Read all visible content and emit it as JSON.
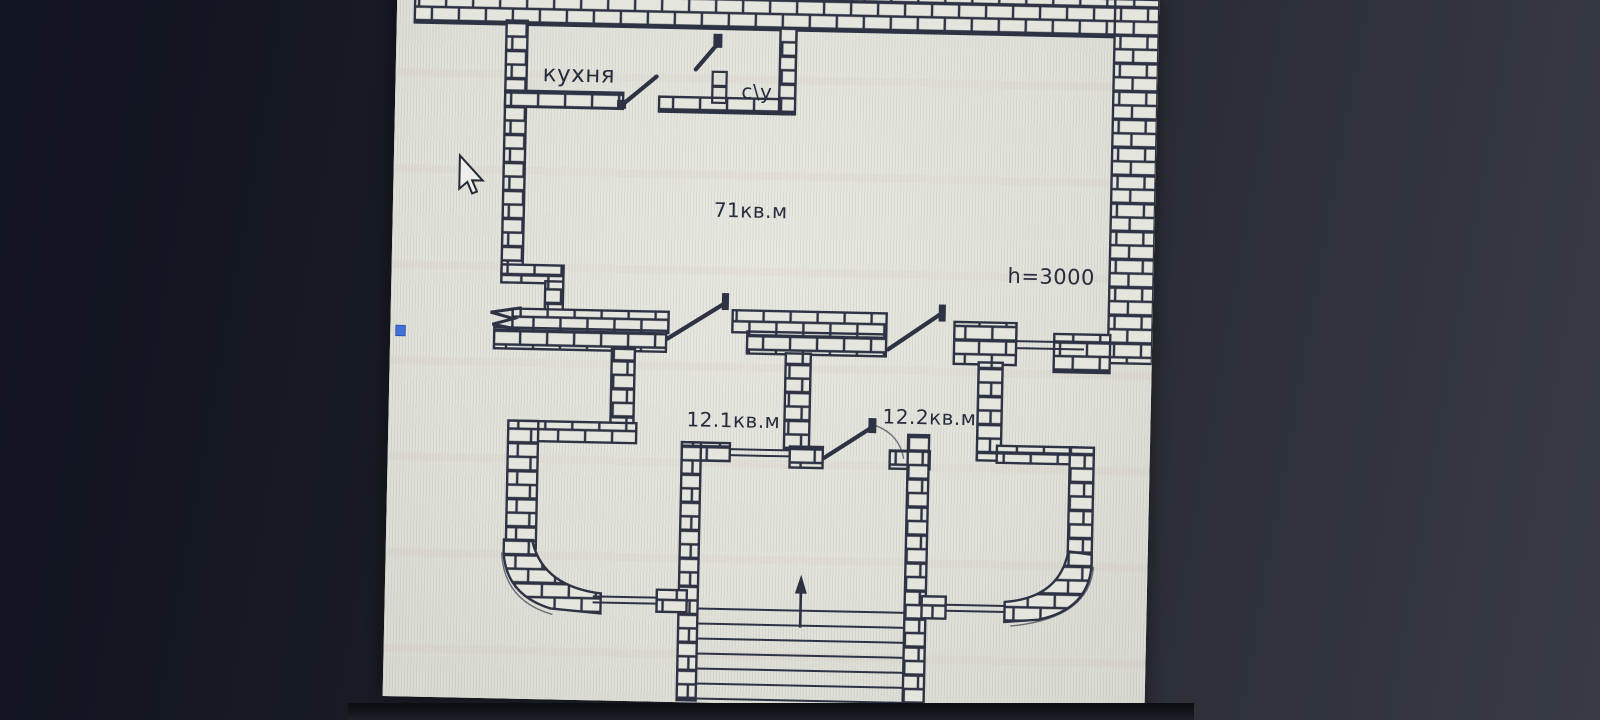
{
  "floorplan": {
    "labels": {
      "kitchen": "кухня",
      "bathroom": "с\\у",
      "main_area": "71кв.м",
      "ceiling_height": "h=3000",
      "room_left_area": "12.1кв.м",
      "room_right_area": "12.2кв.м"
    },
    "colors": {
      "ink": "#2d3345",
      "paper": "#e0e1d8",
      "screen_background": "#22252e",
      "marker_blue": "#3f6fd8"
    }
  }
}
